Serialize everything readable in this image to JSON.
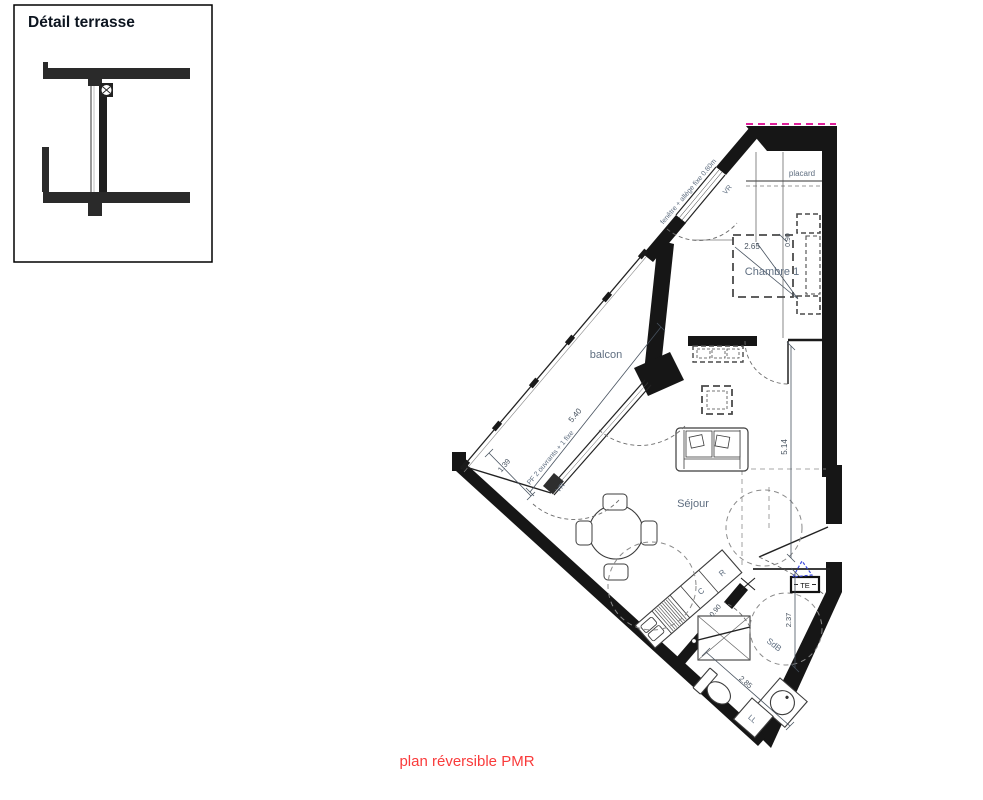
{
  "inset": {
    "title": "Détail terrasse"
  },
  "rooms": {
    "balcony": "balcon",
    "bedroom": "Chambre 1",
    "closet": "placard",
    "living": "Séjour",
    "bathroom": "SdB"
  },
  "labels": {
    "window_upper": "fenêtre + allège fixe 0.80m",
    "roller_shutter_upper": "VR",
    "window_lower": "PF 2 ouvrants + 1 fixe",
    "roller_shutter_lower": "VR",
    "electrical_panel": "TE",
    "washing_machine": "LL",
    "cooktop": "C",
    "fridge": "R"
  },
  "dimensions": {
    "window_length": "5.40",
    "balcony_depth": "1.39",
    "bedroom_width": "2.65",
    "bedroom_side": "0.90",
    "living_length": "5.14",
    "bathroom_length": "2.37",
    "bathroom_width": "2.85",
    "bathroom_door": "0.90"
  },
  "caption": "plan réversible PMR",
  "colors": {
    "wall": "#161616",
    "caption_red": "#f93b3b",
    "boundary_magenta": "#df219b",
    "marker_blue": "#3b49dd",
    "label_gray": "#5f6e80"
  }
}
